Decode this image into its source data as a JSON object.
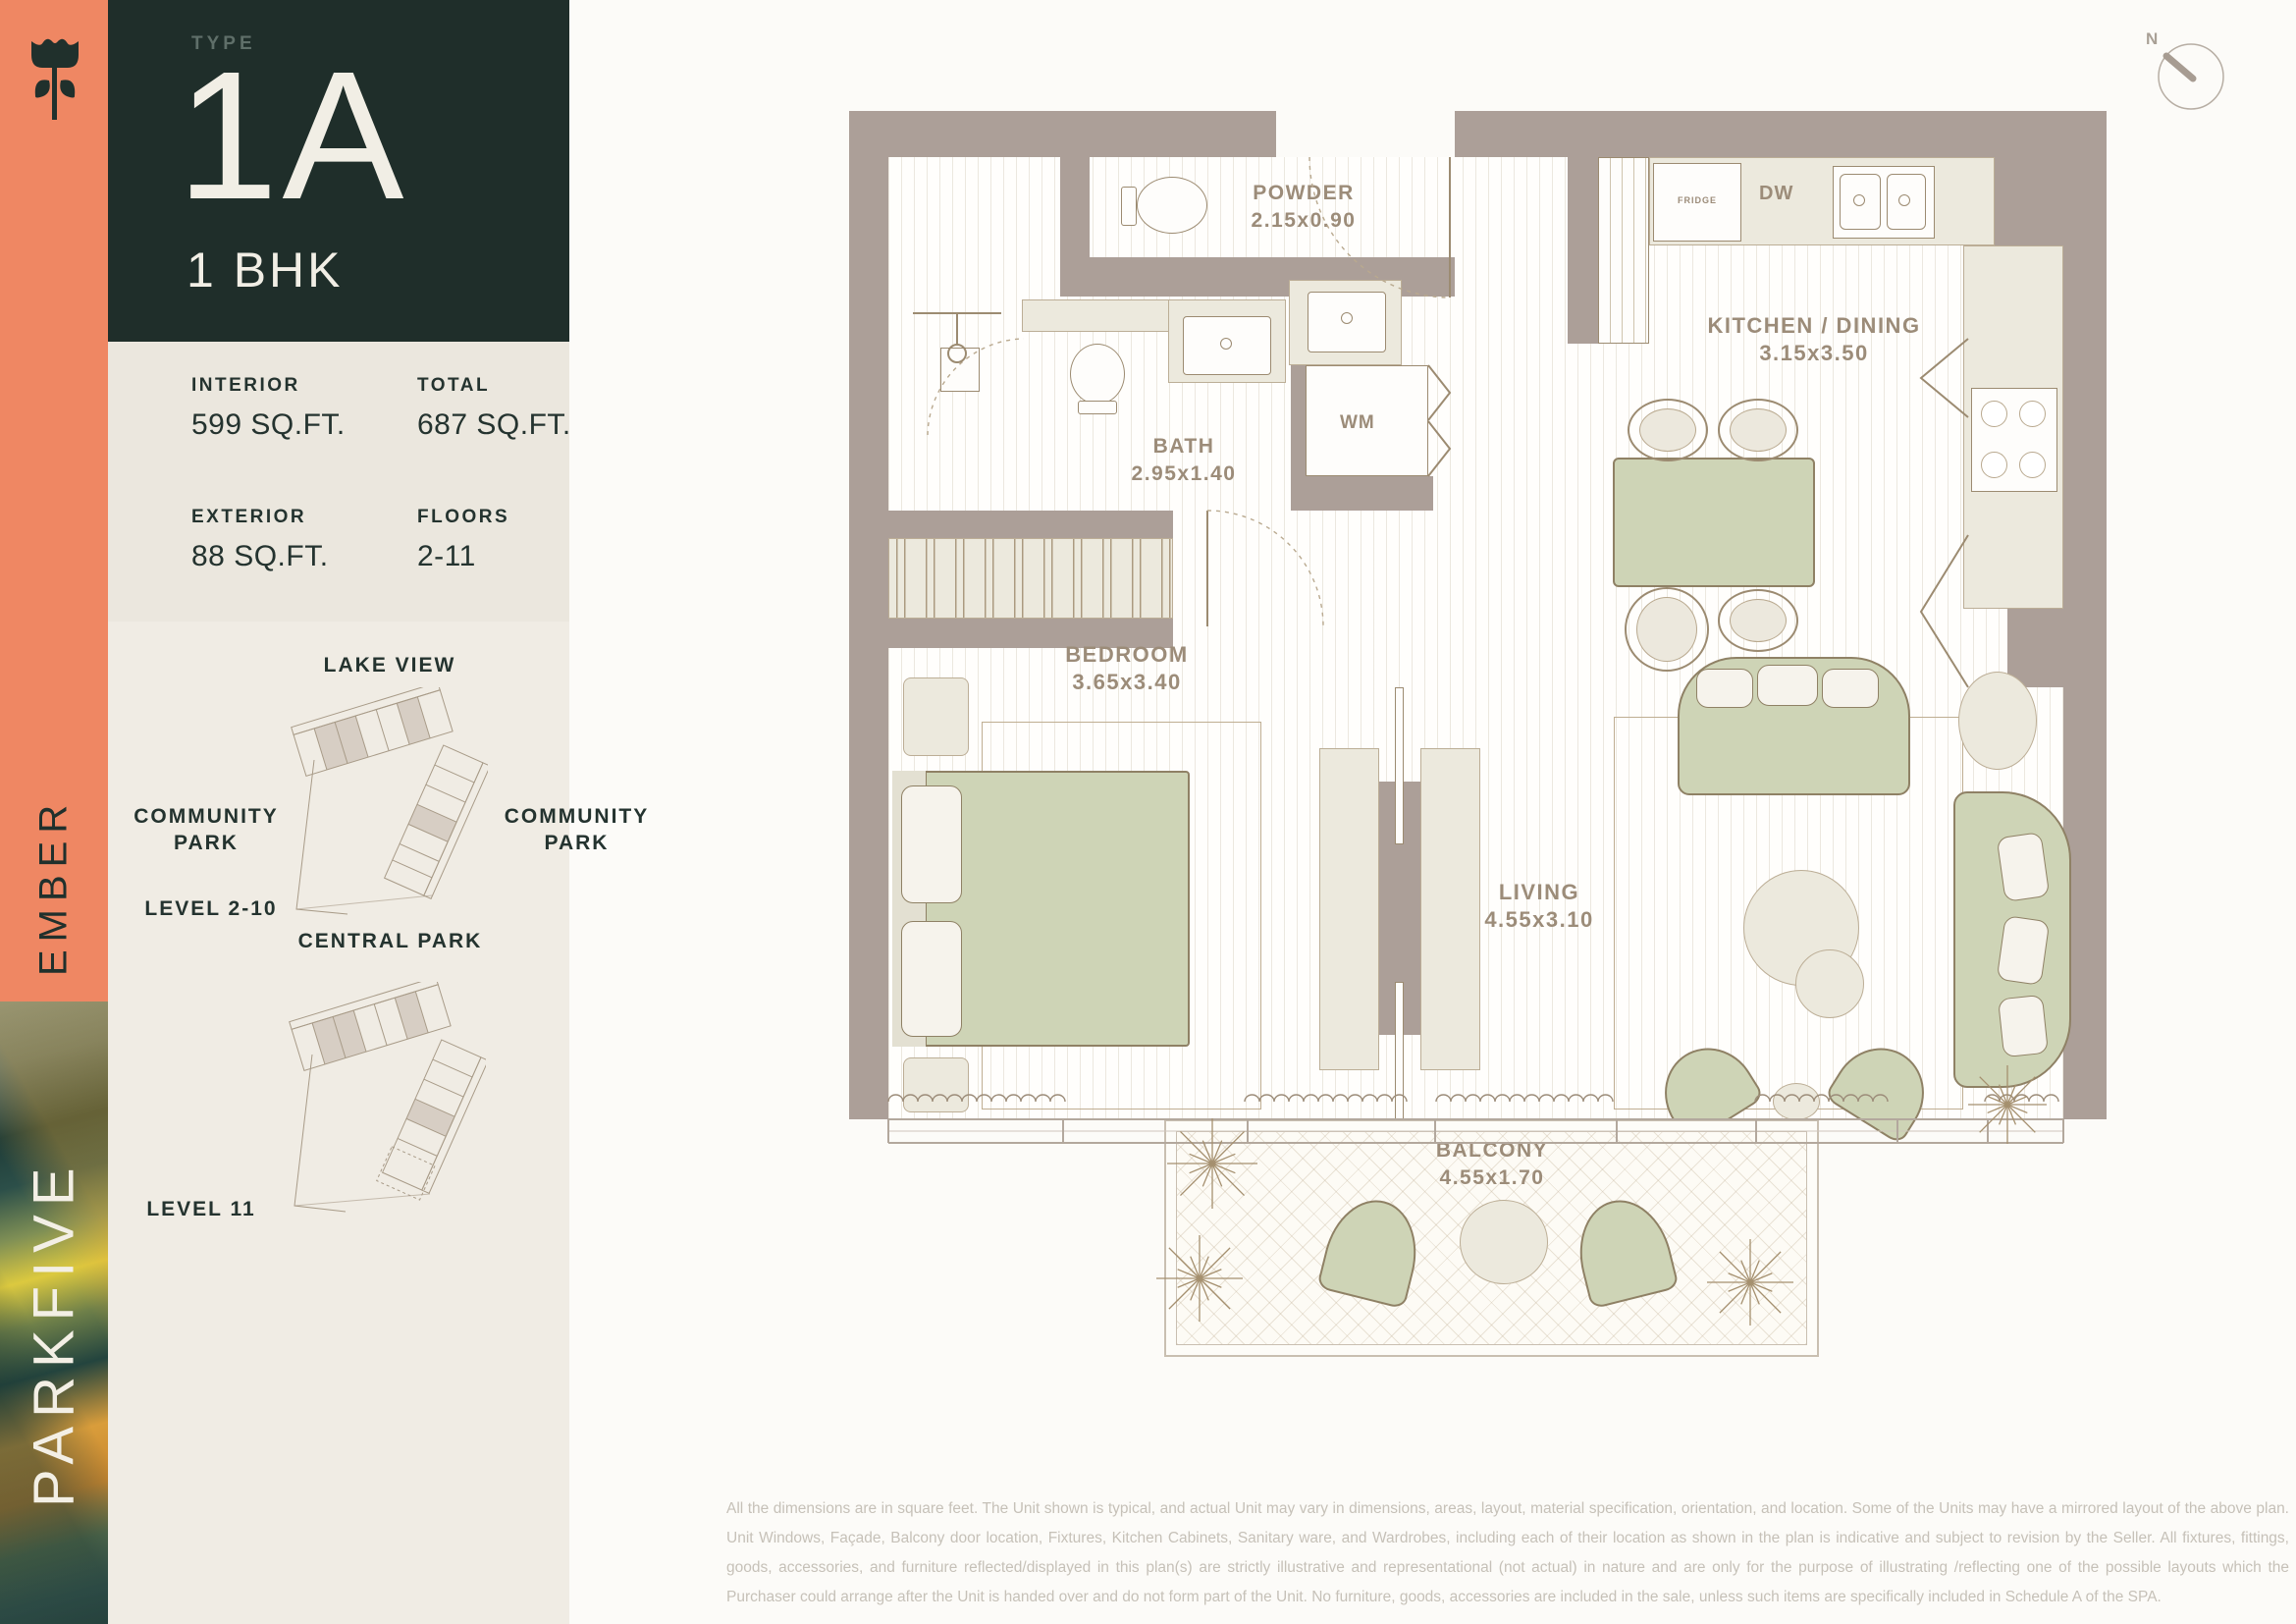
{
  "brand": {
    "project": "PARKFIVE",
    "building": "EMBER"
  },
  "unit": {
    "type_label": "TYPE",
    "type": "1A",
    "config": "1 BHK"
  },
  "stats": {
    "interior_label": "INTERIOR",
    "interior": "599 SQ.FT.",
    "total_label": "TOTAL",
    "total": "687 SQ.FT.",
    "exterior_label": "EXTERIOR",
    "exterior": "88 SQ.FT.",
    "floors_label": "FLOORS",
    "floors": "2-11"
  },
  "site": {
    "lake_view": "LAKE VIEW",
    "community_park_left": "COMMUNITY PARK",
    "community_park_right": "COMMUNITY PARK",
    "central_park": "CENTRAL PARK",
    "level_2_10": "LEVEL 2-10",
    "level_11": "LEVEL 11"
  },
  "plan": {
    "powder": "POWDER",
    "powder_dims": "2.15x0.90",
    "bath": "BATH",
    "bath_dims": "2.95x1.40",
    "kitchen": "KITCHEN / DINING",
    "kitchen_dims": "3.15x3.50",
    "bedroom": "BEDROOM",
    "bedroom_dims": "3.65x3.40",
    "living": "LIVING",
    "living_dims": "4.55x3.10",
    "balcony": "BALCONY",
    "balcony_dims": "4.55x1.70",
    "fridge": "FRIDGE",
    "dw": "DW",
    "wm": "WM",
    "north": "N"
  },
  "disclaimer": {
    "text": "All the dimensions are in square feet. The Unit shown is typical, and actual Unit may vary in dimensions, areas, layout, material specification, orientation, and location. Some of the Units may have a mirrored layout of the above plan. Unit Windows, Façade, Balcony door location, Fixtures, Kitchen Cabinets, Sanitary ware, and Wardrobes, including each of their location as shown in the plan is indicative and subject to revision by the Seller. All fixtures, fittings, goods, accessories, and furniture reflected/displayed in this plan(s) are strictly illustrative and representational (not actual) in nature and are only for the purpose of illustrating /reflecting one of the possible layouts which the Purchaser could arrange after the Unit is handed over and do not form part of the Unit. No furniture, goods, accessories are included in the sale, unless such items are specifically included in Schedule A of the SPA."
  },
  "colors": {
    "accent_orange": "#ef8763",
    "dark_teal": "#1f2e2a",
    "wall_taupe": "#ac9f98",
    "furniture_green": "#ced4b6",
    "panel_beige": "#f0ece4",
    "label_brown": "#9c8c79"
  }
}
